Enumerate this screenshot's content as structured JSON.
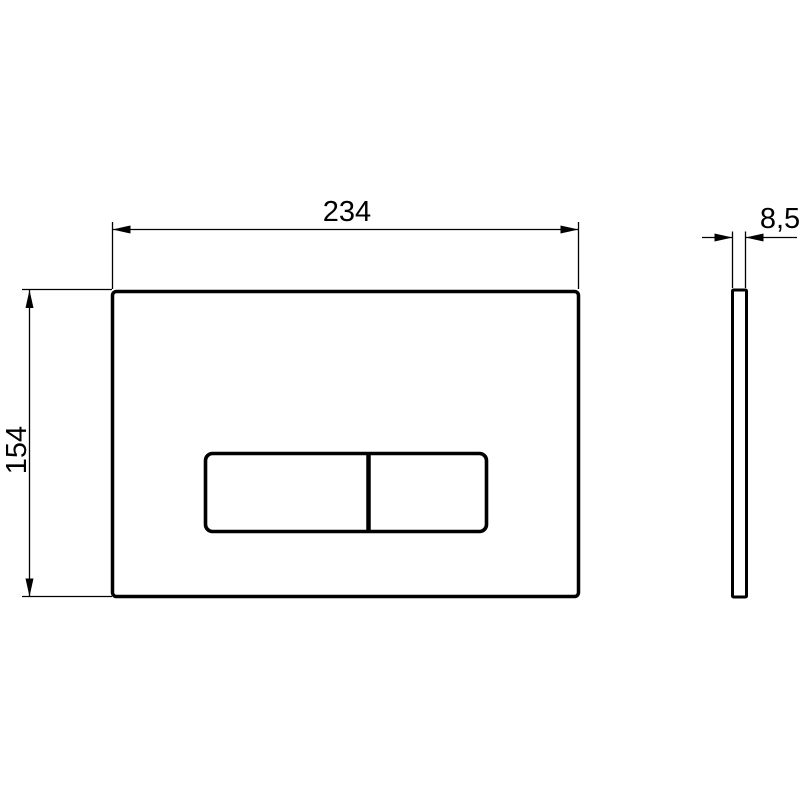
{
  "drawing": {
    "kind": "technical-dimension-drawing",
    "background_color": "#ffffff",
    "line_color": "#000000",
    "views": {
      "front": "front-view-plate-with-two-buttons",
      "side": "side-profile-view"
    },
    "dimensions": {
      "width_label": "234",
      "height_label": "154",
      "thickness_label": "8,5"
    }
  }
}
